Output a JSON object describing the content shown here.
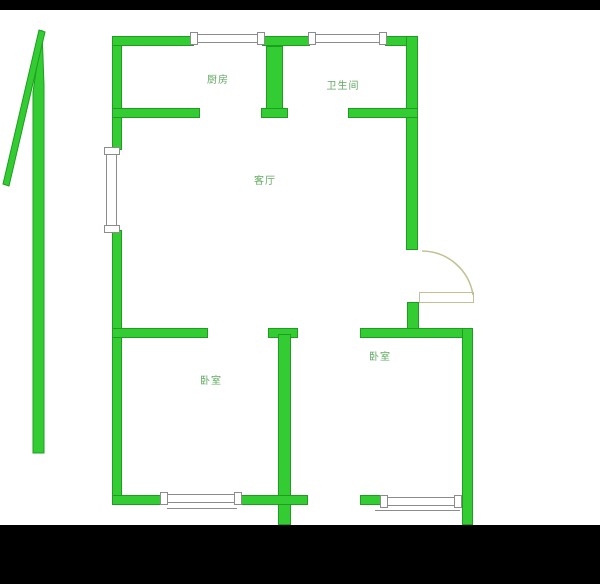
{
  "colors": {
    "wall_fill": "#33CC33",
    "wall_border": "#1E9E1E",
    "label_text": "#62A862",
    "door": "#C2C193",
    "window_border": "#8C8C8C",
    "background": "#FFFFFF",
    "letterbox": "#000000"
  },
  "rooms": {
    "kitchen": {
      "label": "厨房"
    },
    "bathroom": {
      "label": "卫生间"
    },
    "living_room": {
      "label": "客厅"
    },
    "bedroom_left": {
      "label": "卧室"
    },
    "bedroom_right": {
      "label": "卧室"
    }
  }
}
